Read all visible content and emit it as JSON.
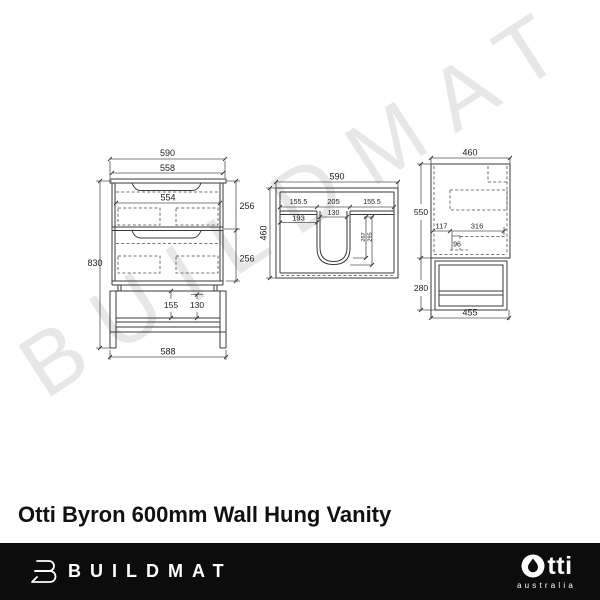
{
  "watermark_text": "BUILDMAT",
  "product_title": "Otti Byron 600mm Wall Hung Vanity",
  "front_view": {
    "overall_width": "590",
    "carcass_width": "558",
    "drawer_inner_width": "554",
    "top_drawer_height": "256",
    "bottom_drawer_height": "256",
    "overall_height": "830",
    "shelf_clearance": "155",
    "shelf_inner_height": "130",
    "base_width": "588"
  },
  "plan_view": {
    "overall_width": "590",
    "overall_depth": "460",
    "left_offset": "155.5",
    "basin_opening": "205",
    "right_offset": "155.5",
    "basin_inner_width": "130",
    "left_inner_offset": "193",
    "basin_depth_a": "267",
    "basin_depth_b": "295"
  },
  "side_view": {
    "overall_depth": "460",
    "cabinet_height": "550",
    "back_offset": "117",
    "cutout_depth": "316",
    "cutout_drop": "96",
    "shelf_unit_height": "280",
    "base_depth": "455"
  },
  "footer": {
    "brand": "BUILDMAT",
    "otti_rest": "tti",
    "otti_sub": "australia"
  }
}
